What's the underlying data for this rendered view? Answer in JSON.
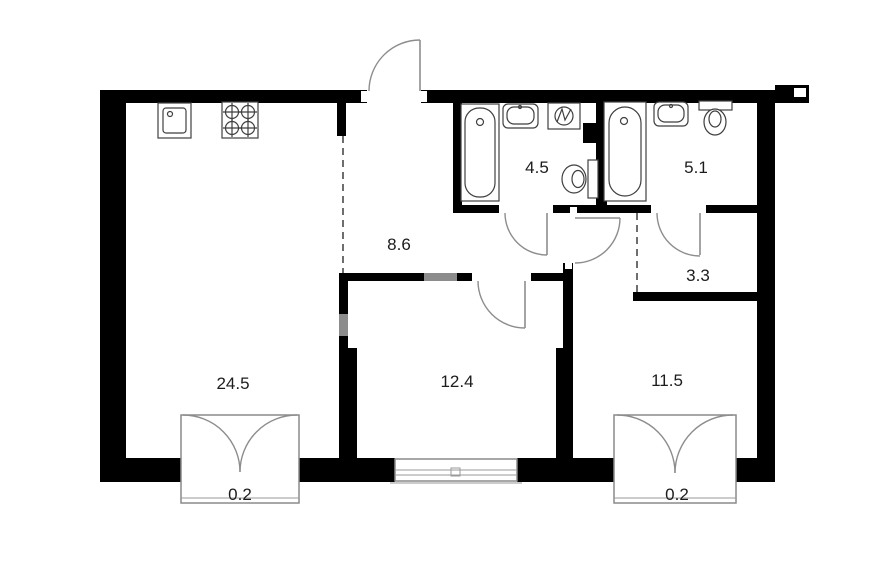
{
  "plan": {
    "type": "apartment-floor-plan",
    "rooms": [
      {
        "id": "living-kitchen",
        "area": "24.5"
      },
      {
        "id": "hallway",
        "area": "8.6"
      },
      {
        "id": "bathroom-1",
        "area": "4.5"
      },
      {
        "id": "bathroom-2",
        "area": "5.1"
      },
      {
        "id": "hall-nook",
        "area": "3.3"
      },
      {
        "id": "room-1",
        "area": "12.4"
      },
      {
        "id": "room-2",
        "area": "11.5"
      },
      {
        "id": "balcony-1",
        "area": "0.2"
      },
      {
        "id": "balcony-2",
        "area": "0.2"
      }
    ],
    "fixtures": [
      "kitchen-sink",
      "cooktop",
      "bathtub",
      "wash-basin",
      "washing-machine",
      "toilet",
      "bathtub",
      "wash-basin",
      "toilet"
    ],
    "colors": {
      "wall": "#000000",
      "fixture_line": "#3f3f3f",
      "door_arc": "#8d8d8d",
      "label": "#1c1c1c",
      "background": "#ffffff"
    }
  }
}
